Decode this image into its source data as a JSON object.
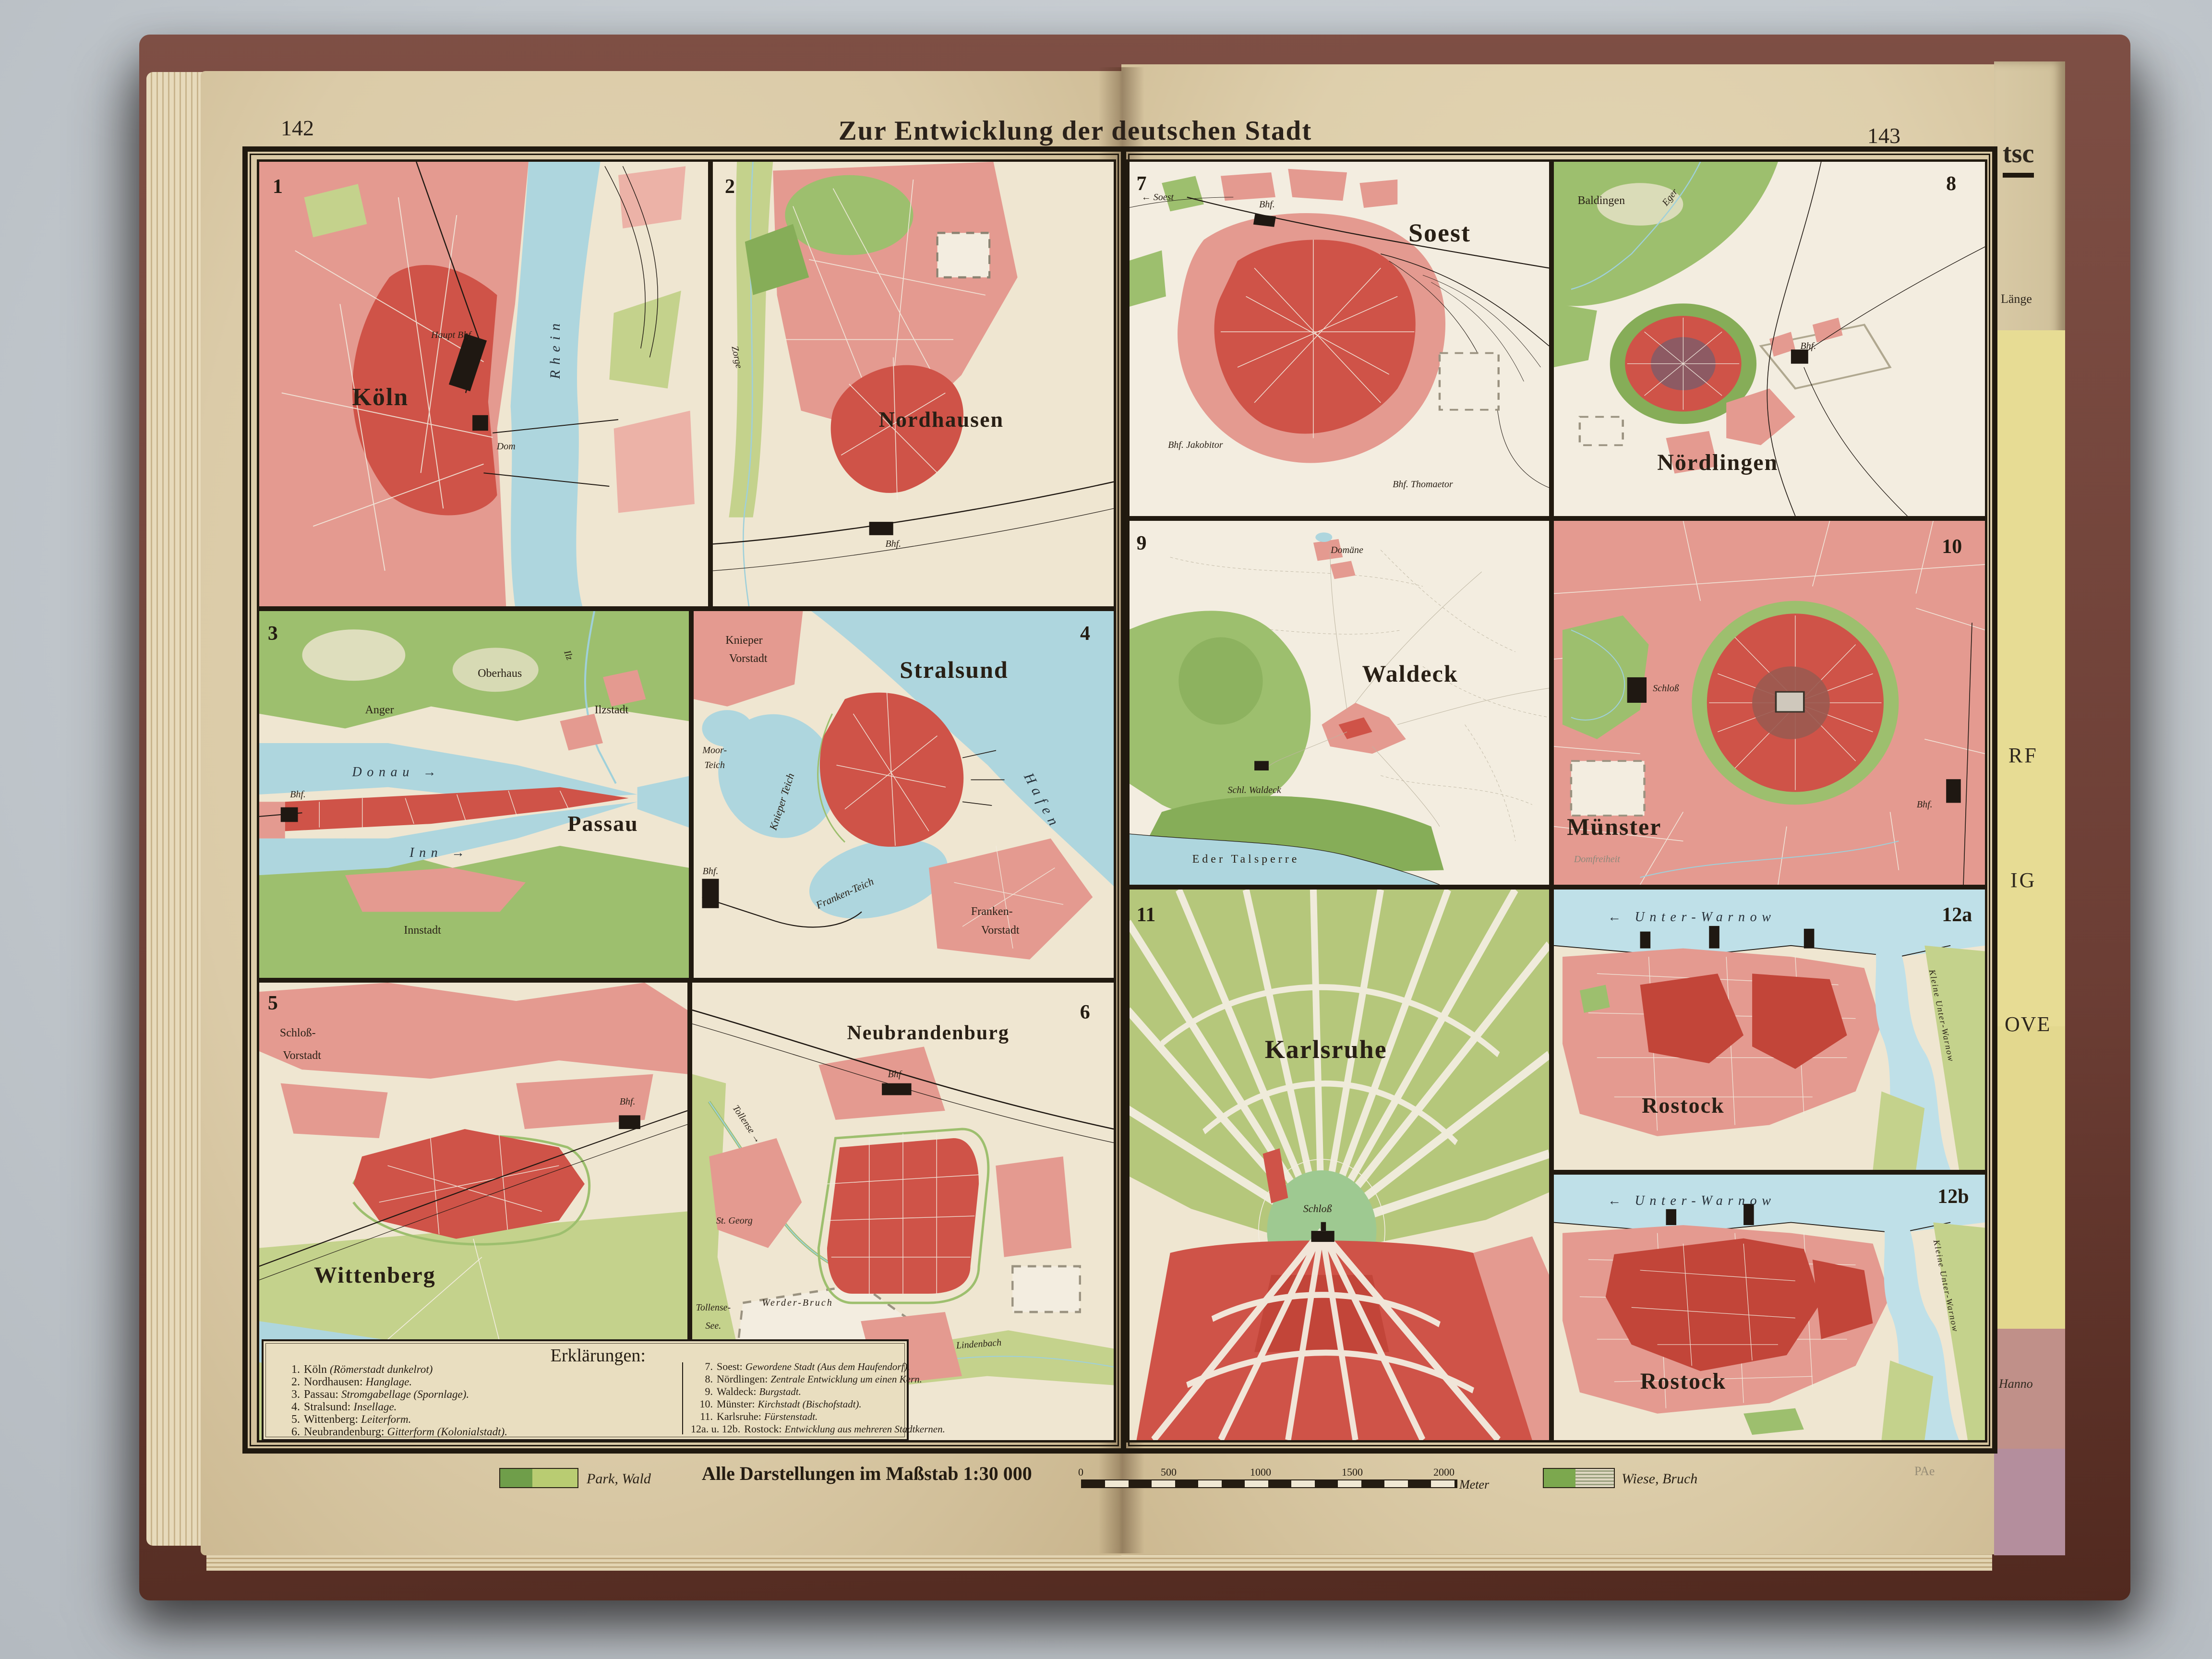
{
  "page": {
    "title": "Zur Entwicklung der deutschen Stadt",
    "left_page_number": "142",
    "right_page_number": "143",
    "printer_mark": "PAe"
  },
  "panels": {
    "p1": {
      "num": "1",
      "city": "Köln",
      "labels": {
        "hauptbhf": "Haupt Bhf.",
        "dom": "Dom",
        "river": "Rhein"
      }
    },
    "p2": {
      "num": "2",
      "city": "Nordhausen",
      "labels": {
        "river": "Zorge",
        "bhf": "Bhf."
      }
    },
    "p3": {
      "num": "3",
      "city": "Passau",
      "labels": {
        "oberhaus": "Oberhaus",
        "anger": "Anger",
        "ilzstadt": "Ilzstadt",
        "ilz": "Ilz",
        "donau": "Donau →",
        "inn": "Inn →",
        "bhf": "Bhf.",
        "innstadt": "Innstadt"
      }
    },
    "p4": {
      "num": "4",
      "city": "Stralsund",
      "labels": {
        "kv1": "Knieper",
        "kv2": "Vorstadt",
        "m1": "Moor-",
        "m2": "Teich",
        "kteich": "Knieper Teich",
        "fteich": "Franken-Teich",
        "hafen": "Hafen",
        "bhf": "Bhf.",
        "fv1": "Franken-",
        "fv2": "Vorstadt"
      }
    },
    "p5": {
      "num": "5",
      "city": "Wittenberg",
      "labels": {
        "sv1": "Schloß-",
        "sv2": "Vorstadt",
        "bhf": "Bhf.",
        "elbe": "Elbe",
        "arrow": "←"
      }
    },
    "p6": {
      "num": "6",
      "city": "Neubrandenburg",
      "labels": {
        "bhf": "Bhf",
        "tollense": "Tollense →",
        "stgeorg": "St. Georg",
        "lindenbach": "Lindenbach",
        "werder": "Werder-Bruch",
        "see1": "Tollense-",
        "see2": "See."
      }
    },
    "p7": {
      "num": "7",
      "city": "Soest",
      "labels": {
        "soestriver": "← Soest",
        "bhf": "Bhf.",
        "thomaetor": "Bhf. Thomaetor",
        "jakobitor": "Bhf. Jakobitor"
      }
    },
    "p8": {
      "num": "8",
      "city": "Nördlingen",
      "labels": {
        "baldingen": "Baldingen",
        "eger": "Eger",
        "bhf": "Bhf."
      }
    },
    "p9": {
      "num": "9",
      "city": "Waldeck",
      "labels": {
        "domaene": "Domäne",
        "schloss": "Schl. Waldeck",
        "eder": "Eder Talsperre"
      }
    },
    "p10": {
      "num": "10",
      "city": "Münster",
      "labels": {
        "schloss": "Schloß",
        "domfreiheit": "Domfreiheit",
        "bhf": "Bhf."
      }
    },
    "p11": {
      "num": "11",
      "city": "Karlsruhe",
      "labels": {
        "schloss": "Schloß"
      }
    },
    "p12a": {
      "num": "12a",
      "city": "Rostock",
      "labels": {
        "warnow": "← Unter-Warnow",
        "kleine": "Kleine Unter-Warnow"
      }
    },
    "p12b": {
      "num": "12b",
      "city": "Rostock",
      "labels": {
        "warnow": "← Unter-Warnow",
        "kleine": "Kleine Unter-Warnow"
      }
    }
  },
  "legend": {
    "heading": "Erklärungen:",
    "items_left": [
      {
        "num": "1.",
        "name": "Köln",
        "desc": "(Römerstadt dunkelrot)"
      },
      {
        "num": "2.",
        "name": "Nordhausen:",
        "desc": "Hanglage."
      },
      {
        "num": "3.",
        "name": "Passau:",
        "desc": "Stromgabellage (Spornlage)."
      },
      {
        "num": "4.",
        "name": "Stralsund:",
        "desc": "Insellage."
      },
      {
        "num": "5.",
        "name": "Wittenberg:",
        "desc": "Leiterform."
      },
      {
        "num": "6.",
        "name": "Neubrandenburg:",
        "desc": "Gitterform (Kolonialstadt)."
      }
    ],
    "items_right": [
      {
        "num": "7.",
        "name": "Soest:",
        "desc": "Gewordene Stadt (Aus dem Haufendorf)."
      },
      {
        "num": "8.",
        "name": "Nördlingen:",
        "desc": "Zentrale Entwicklung um einen Kern."
      },
      {
        "num": "9.",
        "name": "Waldeck:",
        "desc": "Burgstadt."
      },
      {
        "num": "10.",
        "name": "Münster:",
        "desc": "Kirchstadt (Bischofstadt)."
      },
      {
        "num": "11.",
        "name": "Karlsruhe:",
        "desc": "Fürstenstadt."
      },
      {
        "num": "12a. u. 12b.",
        "name": "Rostock:",
        "desc": "Entwicklung aus mehreren Stadtkernen."
      }
    ]
  },
  "footer": {
    "park_label": "Park, Wald",
    "scale_text": "Alle Darstellungen im Maßstab 1:30 000",
    "scale_ticks": [
      "0",
      "500",
      "1000",
      "1500",
      "2000"
    ],
    "scale_unit": "Meter",
    "wiese_label": "Wiese, Bruch"
  },
  "next_page": {
    "frag_top": "tsc",
    "frag_laenge": "Länge",
    "frag_rf": "RF",
    "frag_ig": "IG",
    "frag_ove": "OVE",
    "frag_hanno": "Hanno"
  },
  "colors": {
    "background": "#c6cbd0",
    "book_cover": "#6b3d34",
    "paper": "#ddcda9",
    "map_cream": "#efe6d1",
    "water": "#aed6de",
    "built_pink": "#e49a90",
    "built_red": "#cf5348",
    "core_maroon": "#8d5a63",
    "park_green": "#9dbf6e",
    "meadow_green": "#c4d28c",
    "line_ink": "#1f1812"
  }
}
